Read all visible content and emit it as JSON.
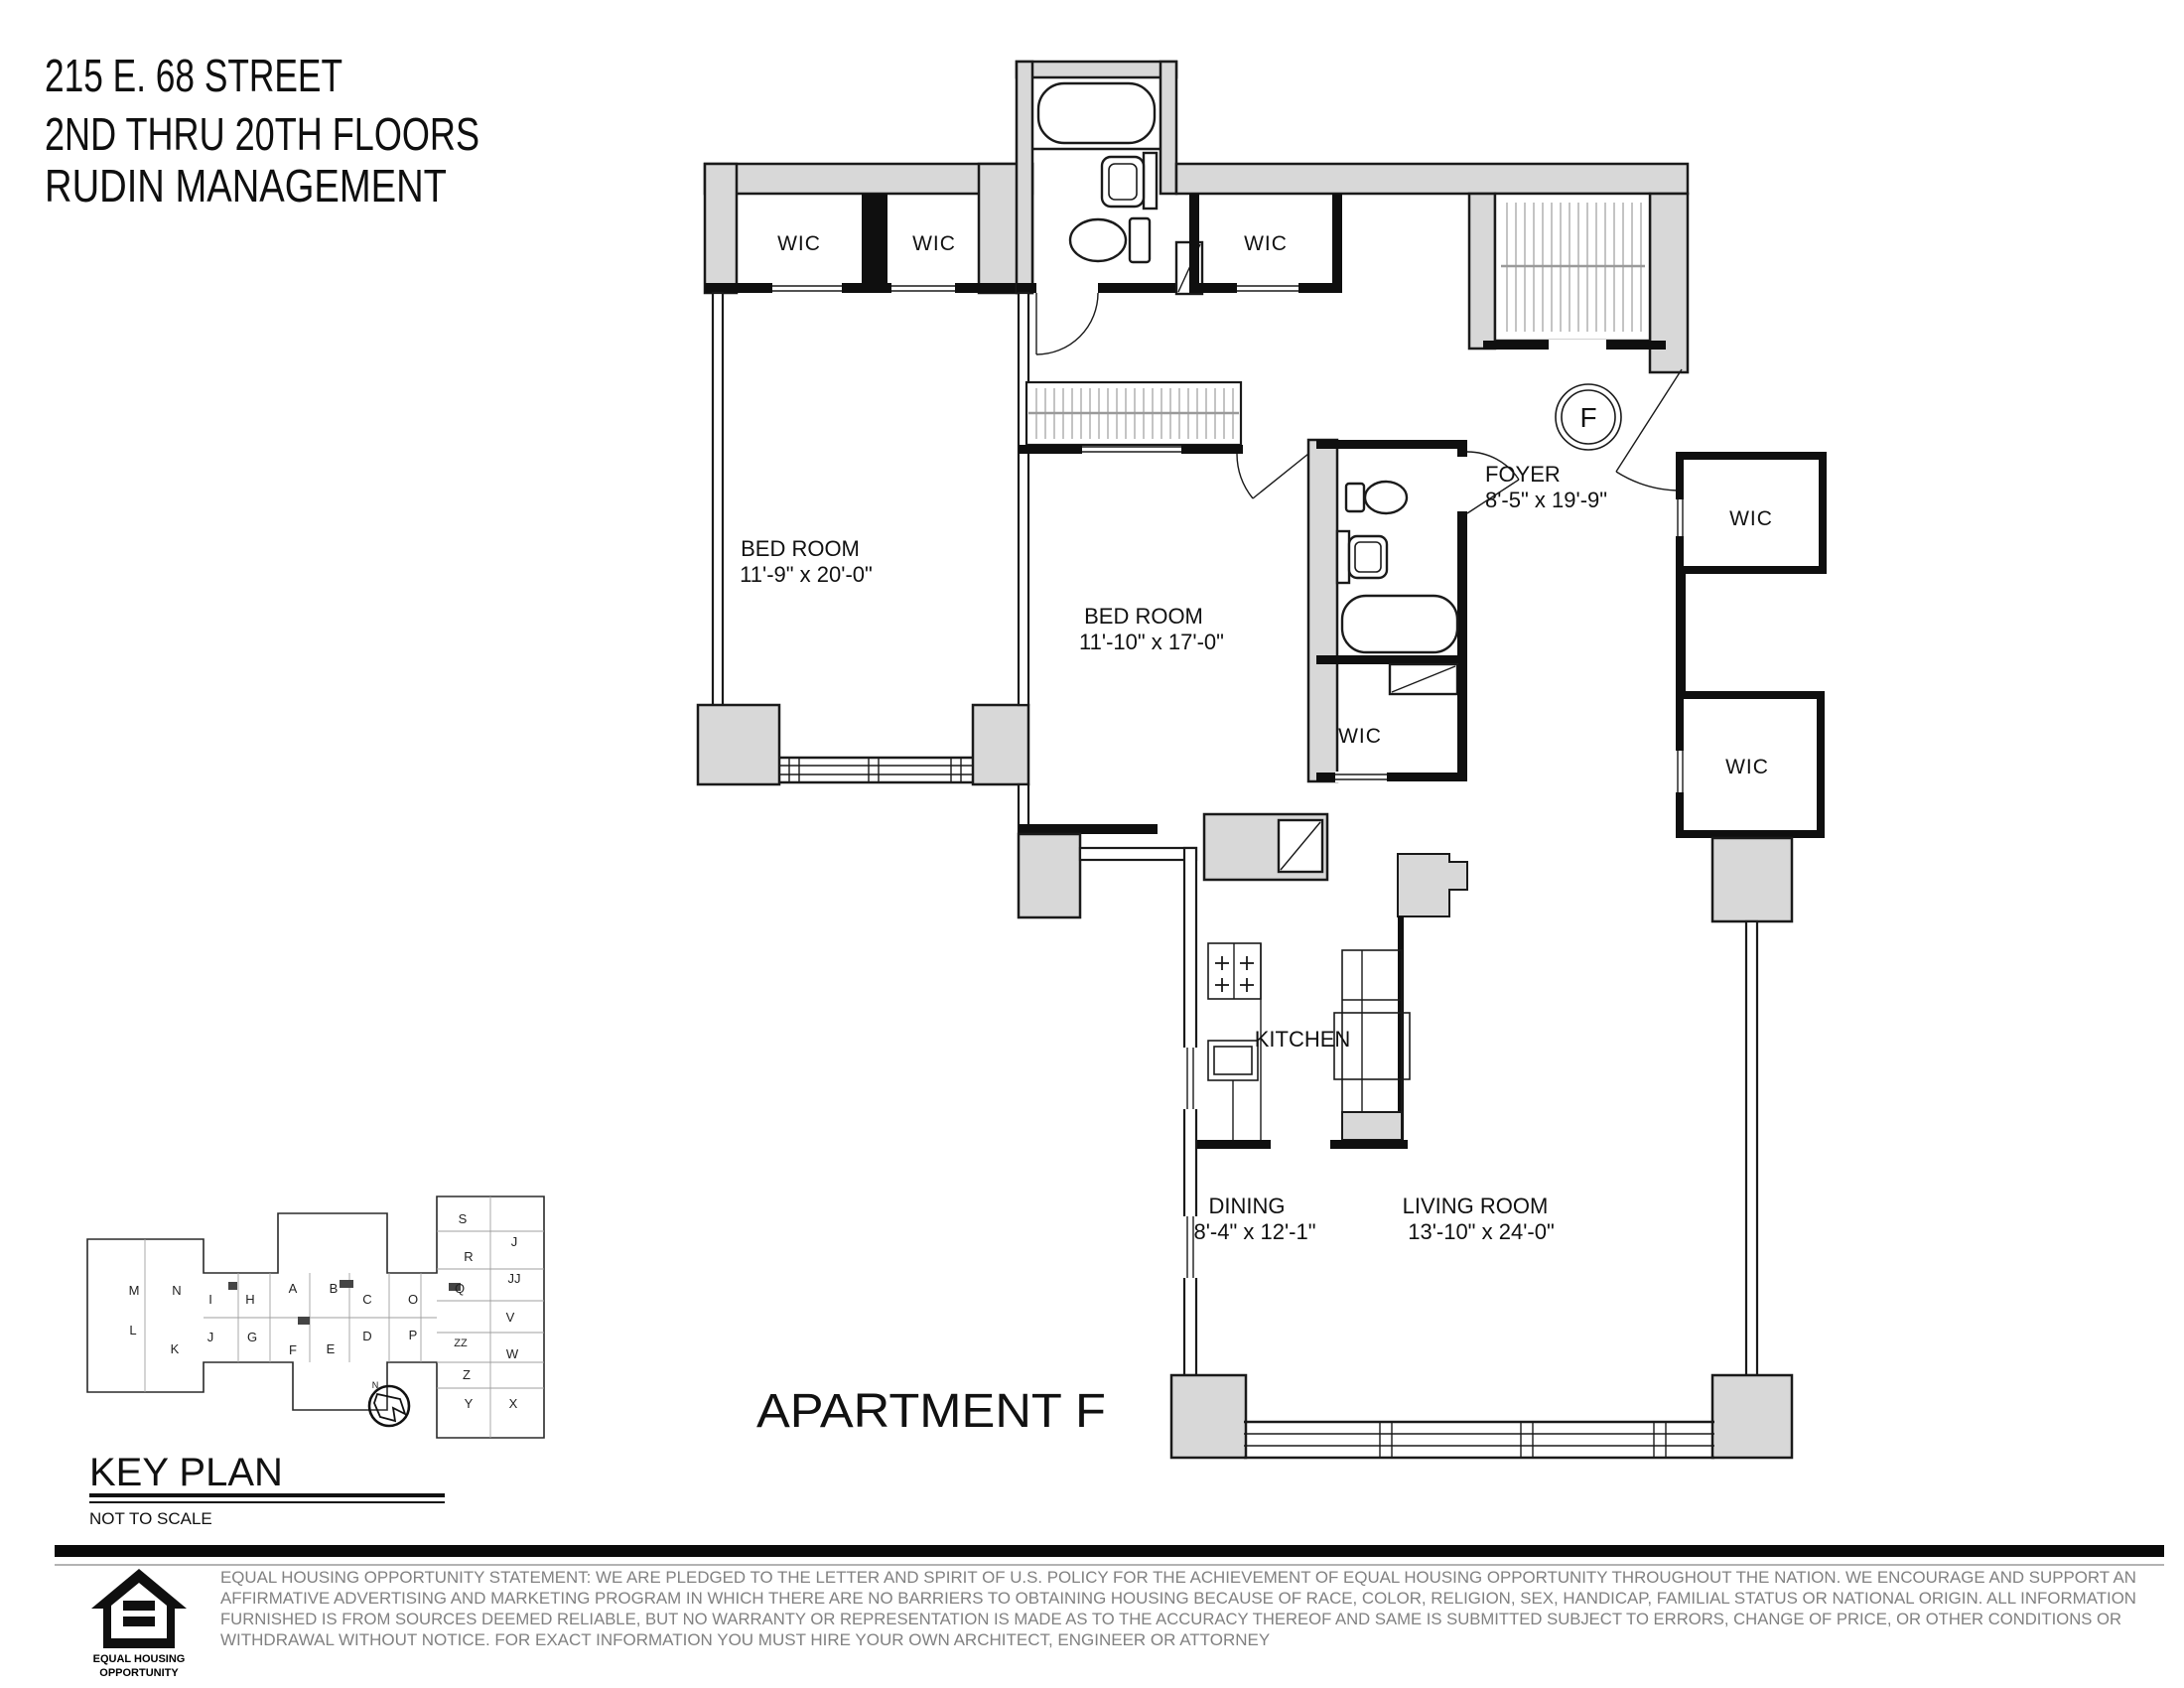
{
  "header": {
    "line1": "215 E. 68 STREET",
    "line2": "2ND THRU 20TH FLOORS",
    "line3": "RUDIN MANAGEMENT"
  },
  "plan": {
    "apartment_label": "APARTMENT F",
    "entry_marker": "F",
    "rooms": {
      "bedroom1": {
        "name": "BED ROOM",
        "dims": "11'-9\" x 20'-0\""
      },
      "bedroom2": {
        "name": "BED ROOM",
        "dims": "11'-10\" x 17'-0\""
      },
      "foyer": {
        "name": "FOYER",
        "dims": "8'-5\" x 19'-9\""
      },
      "kitchen": {
        "name": "KITCHEN"
      },
      "dining": {
        "name": "DINING",
        "dims": "8'-4\" x 12'-1\""
      },
      "living": {
        "name": "LIVING ROOM",
        "dims": "13'-10\" x 24'-0\""
      },
      "wic": {
        "name": "WIC"
      }
    }
  },
  "key_plan": {
    "title": "KEY PLAN",
    "subtitle": "NOT TO SCALE",
    "north_label": "N",
    "units": [
      "M",
      "N",
      "I",
      "H",
      "A",
      "B",
      "C",
      "O",
      "Q",
      "S",
      "R",
      "J",
      "JJ",
      "V",
      "L",
      "K",
      "J",
      "G",
      "F",
      "E",
      "D",
      "P",
      "ZZ",
      "W",
      "Z",
      "Y",
      "X"
    ]
  },
  "footer": {
    "logo_line1": "EQUAL HOUSING",
    "logo_line2": "OPPORTUNITY",
    "disclaimer_lines": [
      "EQUAL HOUSING OPPORTUNITY STATEMENT: WE ARE PLEDGED TO THE LETTER AND SPIRIT OF U.S. POLICY FOR THE ACHIEVEMENT OF EQUAL HOUSING OPPORTUNITY THROUGHOUT THE NATION.  WE ENCOURAGE AND SUPPORT AN",
      "AFFIRMATIVE ADVERTISING AND MARKETING PROGRAM IN WHICH THERE ARE NO BARRIERS TO OBTAINING HOUSING BECAUSE OF RACE, COLOR, RELIGION, SEX, HANDICAP, FAMILIAL STATUS OR NATIONAL ORIGIN.  ALL INFORMATION",
      "FURNISHED IS FROM SOURCES DEEMED RELIABLE, BUT NO WARRANTY OR REPRESENTATION IS MADE AS TO THE ACCURACY THEREOF AND SAME IS SUBMITTED SUBJECT TO ERRORS, CHANGE OF PRICE, OR OTHER CONDITIONS OR",
      "WITHDRAWAL WITHOUT NOTICE.  FOR EXACT INFORMATION YOU MUST HIRE YOUR OWN ARCHITECT, ENGINEER OR ATTORNEY"
    ]
  },
  "colors": {
    "wall_fill": "#d8d8d8",
    "line": "#000000",
    "disclaimer_text": "#818181"
  }
}
